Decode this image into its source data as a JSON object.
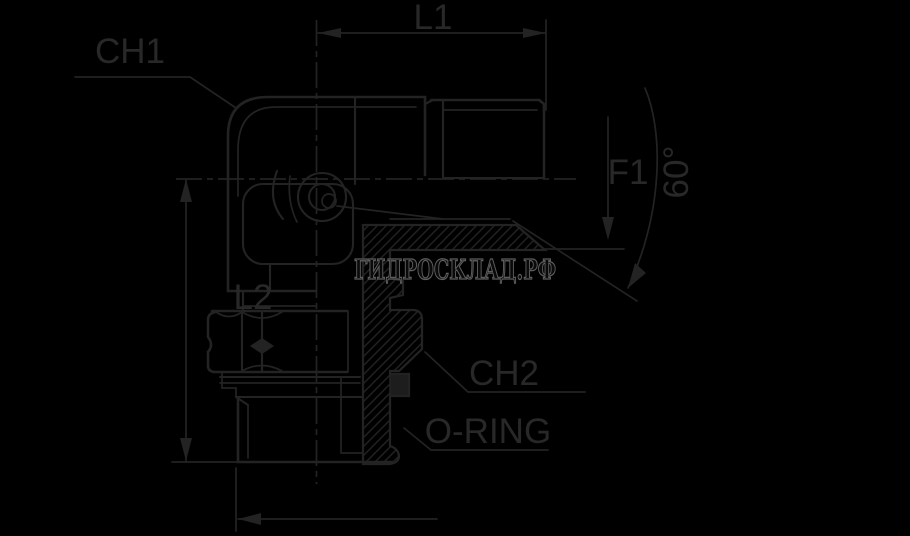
{
  "drawing": {
    "title": "elbow-fitting-technical-drawing",
    "labels": {
      "l1": "L1",
      "ch1": "CH1",
      "f1": "F1",
      "angle": "60°",
      "l2": "L2",
      "ch2": "CH2",
      "oring": "O-RING"
    },
    "watermark": "ГИДРОСКЛАД.РФ",
    "colors": {
      "background": "#000000",
      "line": "#232323",
      "label_text": "#282828",
      "watermark_outline": "#5e5e5e"
    }
  }
}
